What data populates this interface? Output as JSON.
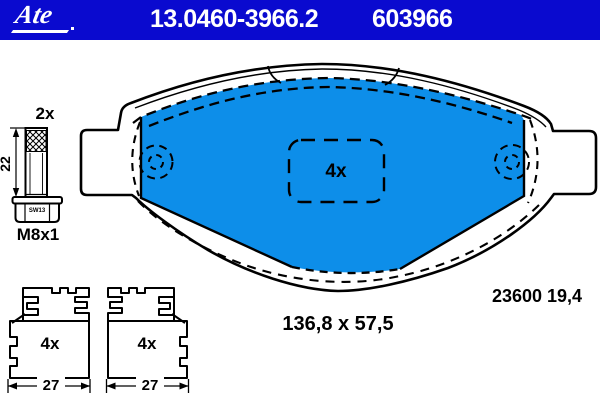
{
  "header": {
    "brand": "Ate",
    "part_number": "13.0460-3966.2",
    "article_code": "603966",
    "bar_color": "#0A0ACF",
    "text_color": "#FFFFFF"
  },
  "bolt": {
    "quantity_label": "2x",
    "length_label": "22",
    "wrench_label": "SW13",
    "thread_label": "M8x1"
  },
  "pad": {
    "kit_quantity_label": "4x",
    "reference_label": "23600 19,4",
    "size_label": "136,8 x 57,5",
    "friction_color": "#0D8EE9",
    "line_color": "#000000"
  },
  "clips": {
    "left": {
      "quantity_label": "4x",
      "width_label": "27"
    },
    "right": {
      "quantity_label": "4x",
      "width_label": "27"
    }
  }
}
